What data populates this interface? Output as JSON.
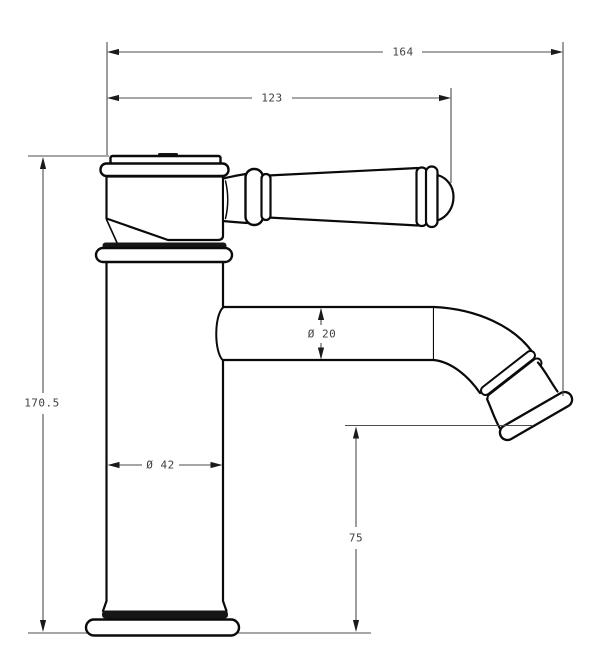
{
  "drawing": {
    "type": "technical-dimension-drawing",
    "subject": "single-lever basin mixer tap, side elevation",
    "units": "mm",
    "line_color": "#0a0a0a",
    "dimension_line_color": "#4d4d4d",
    "background_color": "#ffffff",
    "dimensions": {
      "overall_width": "164",
      "handle_reach": "123",
      "overall_height": "170.5",
      "spout_diameter": "Ø 20",
      "body_diameter": "Ø 42",
      "spout_height": "75"
    }
  }
}
